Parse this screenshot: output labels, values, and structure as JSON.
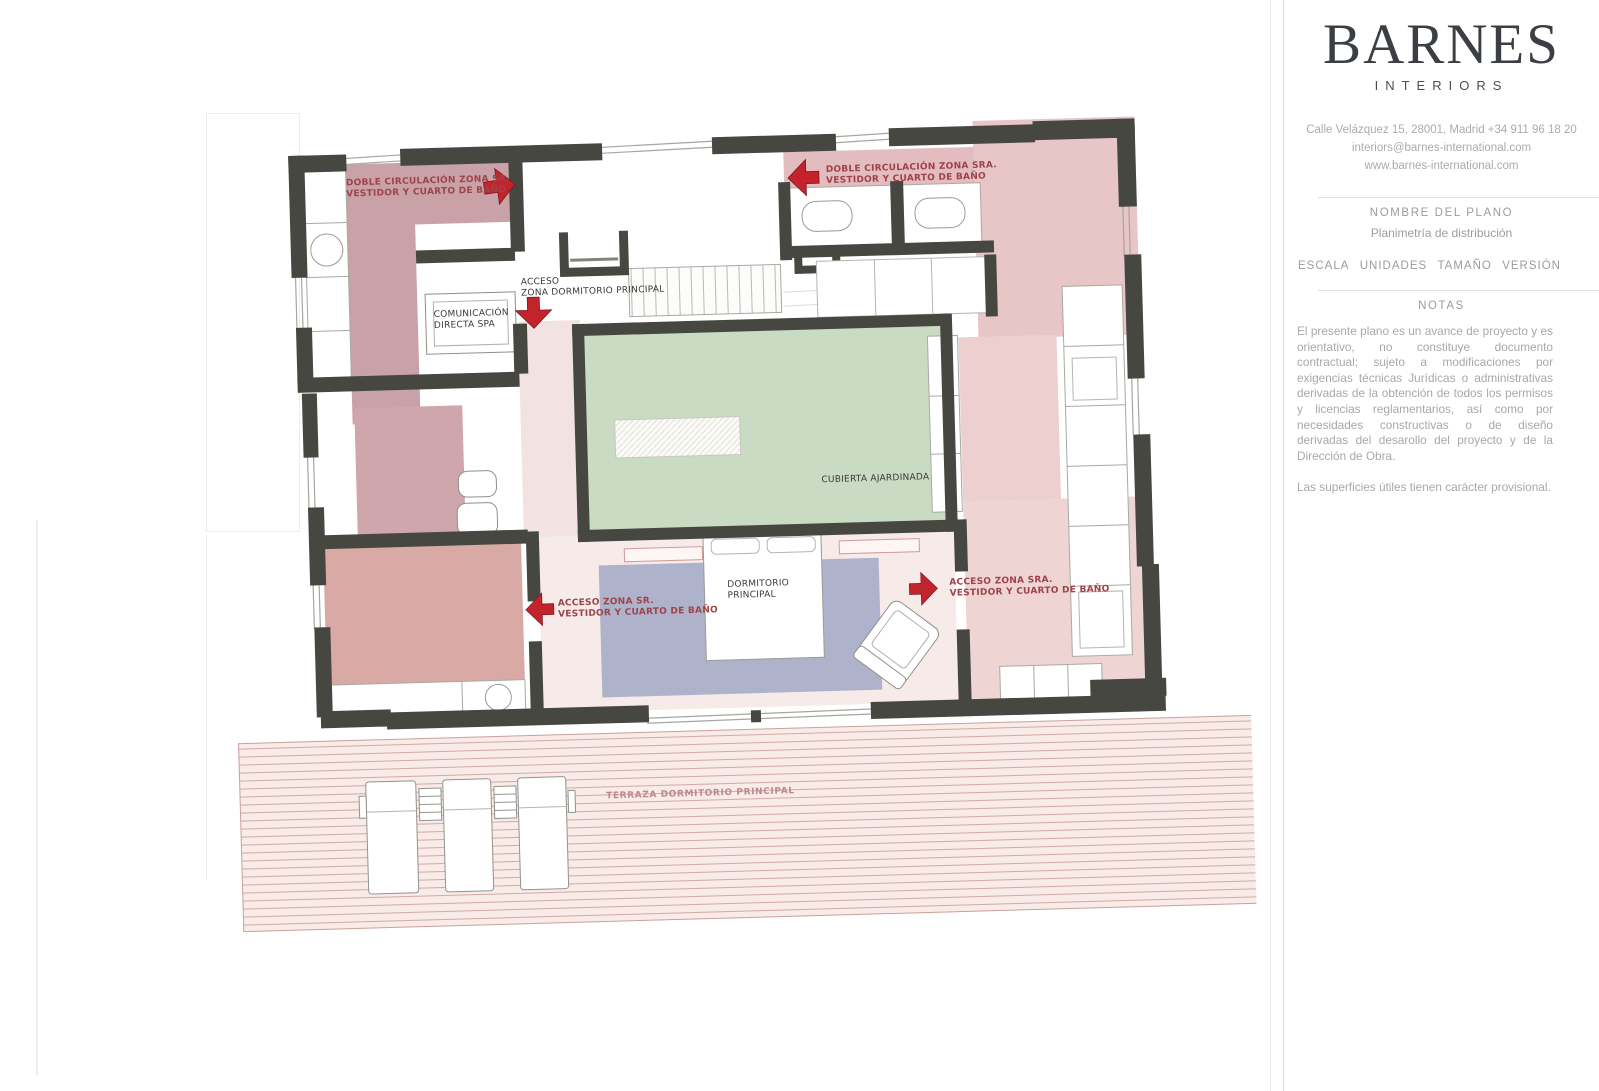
{
  "sidebar": {
    "brand": "BARNES",
    "brand_sub": "INTERIORS",
    "contact": {
      "line1": "Calle Velázquez 15, 28001, Madrid +34 911 96 18 20",
      "line2": "interiors@barnes-international.com",
      "line3": "www.barnes-international.com"
    },
    "plan_section": {
      "title": "NOMBRE DEL PLANO",
      "plan_name": "Planimetría de distribución"
    },
    "meta": {
      "escala": "ESCALA",
      "unidades": "UNIDADES",
      "tamano": "TAMAÑO",
      "version": "VERSIÓN"
    },
    "notes": {
      "title": "NOTAS",
      "paragraph1": "El presente plano es un avance de proyecto y es orientativo, no constituye documento contractual; sujeto a modificaciones por exigencias técnicas Jurídicas o administrativas derivadas de la obtención de todos los permisos y licencias reglamentarios, así como por necesidades constructivas o de diseño derivadas del desarollo del proyecto y de la Dirección de Obra.",
      "paragraph2": "Las superficies útiles tienen carácter provisional."
    }
  },
  "plan": {
    "labels": {
      "doble_sr_1": "DOBLE CIRCULACIÓN ZONA SR.",
      "doble_sr_2": "VESTIDOR Y CUARTO DE BAÑO",
      "doble_sra_1": "DOBLE CIRCULACIÓN ZONA SRA.",
      "doble_sra_2": "VESTIDOR Y CUARTO DE BAÑO",
      "acceso_dorm_1": "ACCESO",
      "acceso_dorm_2": "ZONA DORMITORIO PRINCIPAL",
      "comunicacion_1": "COMUNICACIÓN",
      "comunicacion_2": "DIRECTA SPA",
      "cubierta": "CUBIERTA AJARDINADA",
      "dormitorio_1": "DORMITORIO",
      "dormitorio_2": "PRINCIPAL",
      "acceso_sr_1": "ACCESO ZONA SR.",
      "acceso_sr_2": "VESTIDOR Y CUARTO DE BAÑO",
      "acceso_sra_1": "ACCESO ZONA SRA.",
      "acceso_sra_2": "VESTIDOR Y CUARTO DE BAÑO",
      "terraza": "TERRAZA DORMITORIO PRINCIPAL"
    },
    "colors": {
      "wall": "#474741",
      "arrow_red": "#c3242c",
      "zone_pink_dark": "#c9a2a8",
      "zone_pink_light": "#e8c5c6",
      "zone_salmon": "#d9a9a6",
      "courtyard_green": "#cadbc4",
      "carpet_blue": "#aeb3cb",
      "terrace_base": "#f8ebe8"
    }
  }
}
